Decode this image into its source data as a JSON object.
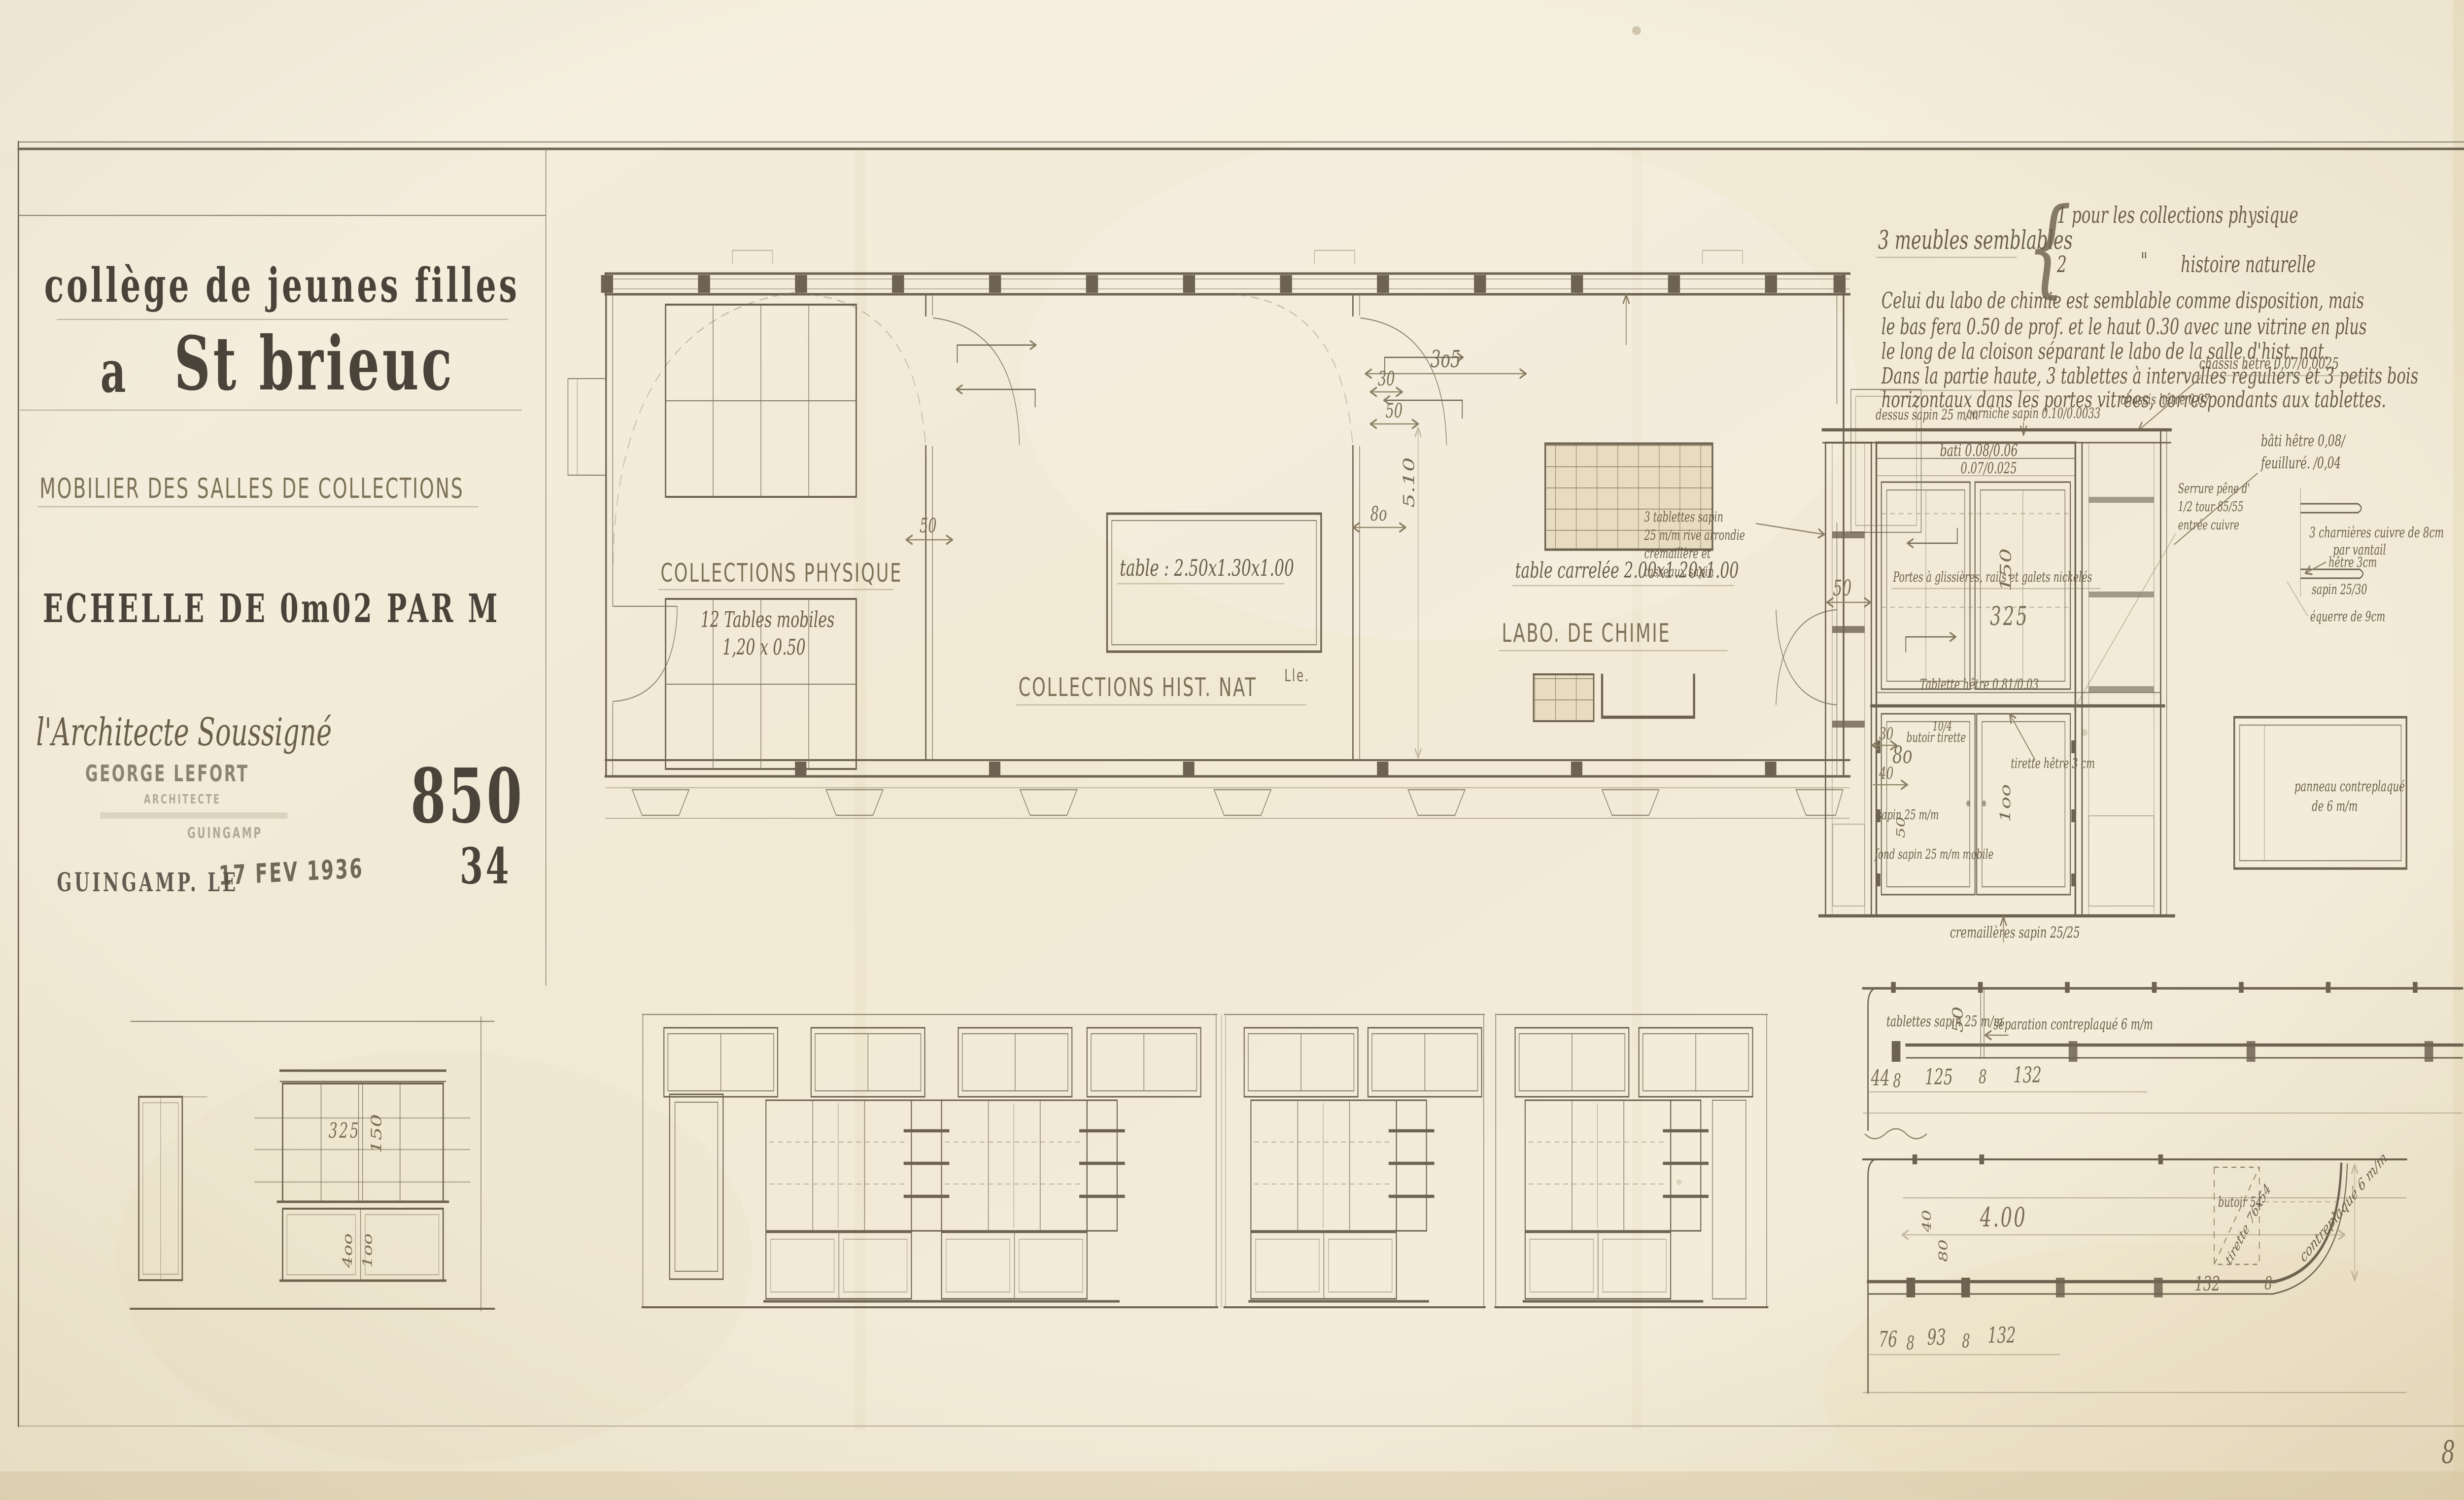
{
  "colors": {
    "paper": "#f2ebd8",
    "ink": "#6d6350",
    "ink_dark": "#49433a",
    "pencil": "#93866b",
    "stamp": "#5a5342"
  },
  "title_block": {
    "line1": "collège de jeunes filles",
    "line2_a": "a",
    "line2_b": "St brieuc",
    "subtitle": "MOBILIER DES SALLES DE COLLECTIONS",
    "scale": "ECHELLE DE 0m02 PAR M",
    "architect": "l'Architecte Soussigné",
    "stamp_name": "GEORGE LEFORT",
    "stamp_title": "ARCHITECTE",
    "stamp_city": "GUINGAMP",
    "date": "GUINGAMP. LE",
    "date_stamp": "17 FEV 1936",
    "dossier": "850",
    "dossier_sub": "34"
  },
  "plan": {
    "room1": {
      "label": "COLLECTIONS PHYSIQUE",
      "note1": "12 Tables mobiles",
      "note2": "1,20 x 0.50"
    },
    "room2": {
      "label": "COLLECTIONS HIST. NAT",
      "label_sup": "Lle.",
      "note": "table : 2.50x1.30x1.00"
    },
    "room3": {
      "label": "LABO. DE CHIMIE",
      "note": "table carrelée 2.00x1.20x1.00"
    },
    "dims": {
      "d1": "3o5",
      "d2": "30",
      "d3": "50",
      "d4": "8o",
      "d5": "5.10",
      "d6": "50"
    }
  },
  "notes": {
    "heading": "3 meubles semblables",
    "brace": "{",
    "item1": "1 pour les collections physique",
    "item2_n": "2",
    "item2_ditto": "\"",
    "item2_t": "histoire naturelle",
    "p1": "Celui du labo de chimie est semblable comme disposition, mais",
    "p2": "le bas fera 0.50 de prof. et le haut 0.30 avec une vitrine en plus",
    "p3": "le long de la cloison séparant le labo de la salle d'hist. nat.",
    "p4": "Dans la partie haute, 3 tablettes à intervalles réguliers et 3 petits bois",
    "p5": "horizontaux dans les portes vitrées, correspondants aux tablettes."
  },
  "cabinet": {
    "dessus": "dessus sapin 25 m/m",
    "corniche": "corniche sapin 0.10/0.0033",
    "chassis_a": "chassis hêtre 0,07",
    "chassis_b": "chassis hêtre 0,07/0,0025",
    "bati1": "bâti hêtre 0,08/",
    "bati2": "feuilluré.  /0,04",
    "rail1": "bati 0.08/0.06",
    "rail2": "0.07/0.025",
    "tabl3_1": "3 tablettes sapin",
    "tabl3_2": "25 m/m rive arrondie",
    "tabl3_3": "cremaillère et",
    "tabl3_4": "tasseaux sapin",
    "portes": "Portes à glissières, rails et galets nickelés",
    "tablette": "Tablette hêtre 0.81/0.03",
    "serrure1": "Serrure pêne d'",
    "serrure2": "1/2 tour  85/55",
    "serrure3": "entrée cuivre",
    "charnieres1": "3 charnières cuivre de 8cm",
    "charnieres2": "par vantail",
    "hetre3": "hêtre 3cm",
    "sapin2530": "sapin 25/30",
    "equerre": "équerre de 9cm",
    "panneau1": "panneau contreplaqué",
    "panneau2": "de 6 m/m",
    "butoir_tirette": "butoir tirette",
    "sapin25": "sapin 25 m/m",
    "fond": "fond sapin 25 m/m mobile",
    "tirette_hetre": "tirette hêtre 3 cm",
    "cremailleres": "cremaillères sapin 25/25",
    "dims": {
      "d50": "50",
      "d150": "150",
      "d325": "325",
      "d30": "30",
      "d80": "8o",
      "d40": "40",
      "d50b": "50",
      "d104": "10/4",
      "d100": "1oo"
    }
  },
  "counter_plan": {
    "tablettes": "tablettes sapin 25 m/m",
    "separation": "séparation contreplaqué 6 m/m",
    "dims": {
      "d44": "44",
      "d8a": "8",
      "d125": "125",
      "d8b": "8",
      "d132": "132",
      "d50": "50"
    }
  },
  "base_plan": {
    "butoir": "butoir  54",
    "tirette": "tirette 76x54",
    "contreplaque": "contreplaqué 6 m/m",
    "dims": {
      "d400": "4.00",
      "d40": "40",
      "d80": "80",
      "d76": "76",
      "d8a": "8",
      "d93": "93",
      "d8b": "8",
      "d132": "132",
      "d132b": "132",
      "d8c": "8"
    }
  },
  "elevation_left": {
    "dims": {
      "d325": "325",
      "d150": "150",
      "d400": "4oo",
      "d100": "1oo"
    }
  },
  "page_number": "8"
}
